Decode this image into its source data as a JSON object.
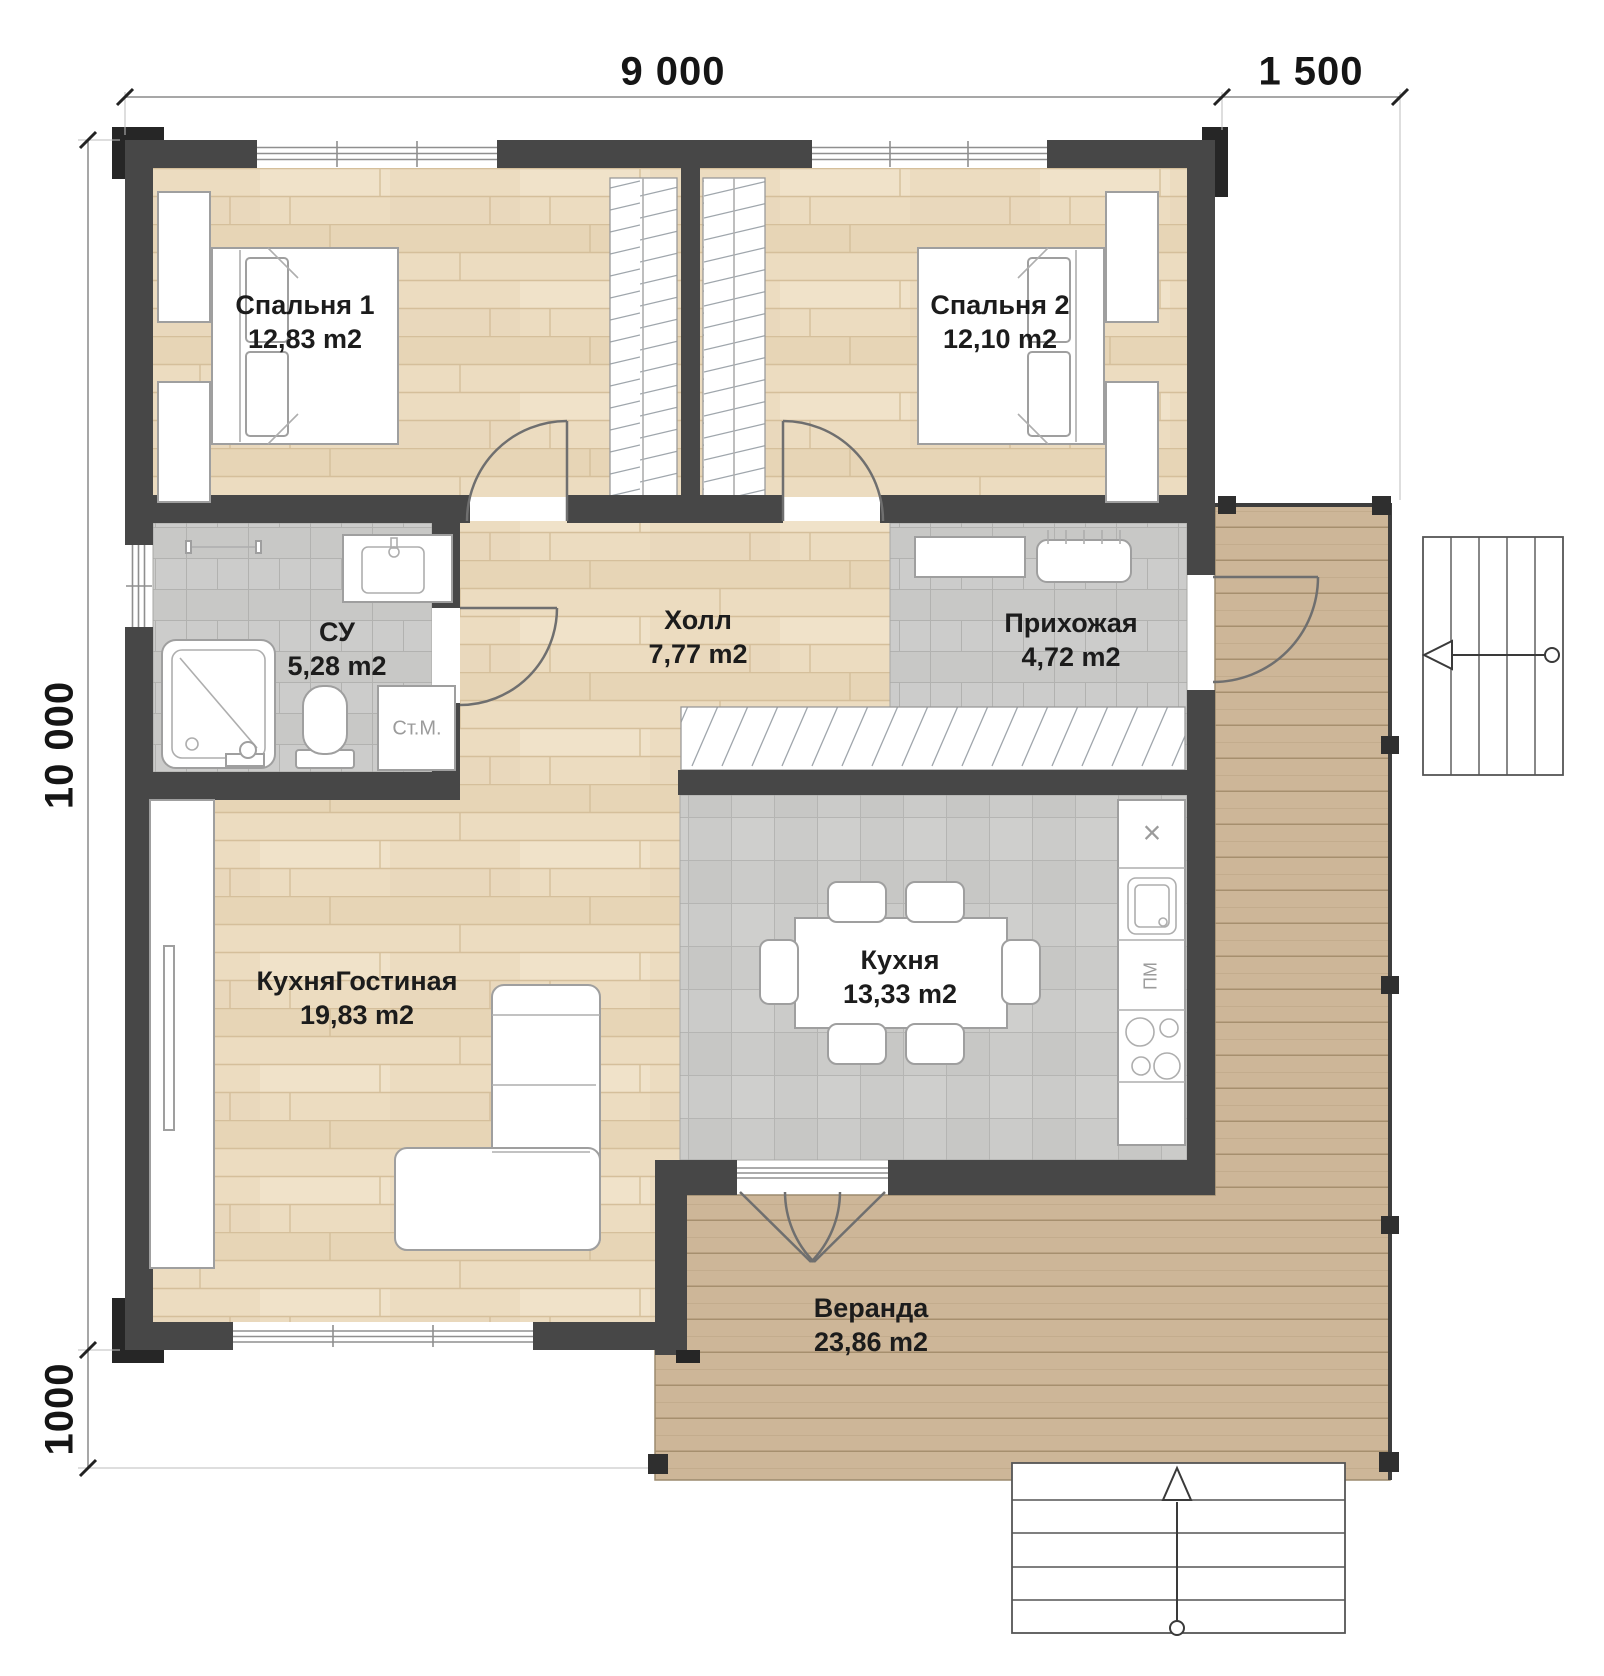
{
  "dimensions": {
    "top_main": "9 000",
    "top_right": "1 500",
    "left_main": "10 000",
    "left_bottom": "1000"
  },
  "rooms": [
    {
      "name": "Спальня 1",
      "area": "12,83 m2"
    },
    {
      "name": "Спальня 2",
      "area": "12,10 m2"
    },
    {
      "name": "СУ",
      "area": "5,28 m2"
    },
    {
      "name": "Холл",
      "area": "7,77 m2"
    },
    {
      "name": "Прихожая",
      "area": "4,72 m2"
    },
    {
      "name": "КухняГостиная",
      "area": "19,83 m2"
    },
    {
      "name": "Кухня",
      "area": "13,33 m2"
    },
    {
      "name": "Веранда",
      "area": "23,86 m2"
    }
  ],
  "appliances": {
    "washing_machine": "Ст.М.",
    "dishwasher": "ПМ",
    "fridge_marker": "×"
  },
  "colors": {
    "wall": "#474747",
    "wood_floor": "#ecdcc0",
    "tile_floor": "#c8c8c6",
    "deck": "#cdb698",
    "label_text": "#1c1c1c"
  }
}
